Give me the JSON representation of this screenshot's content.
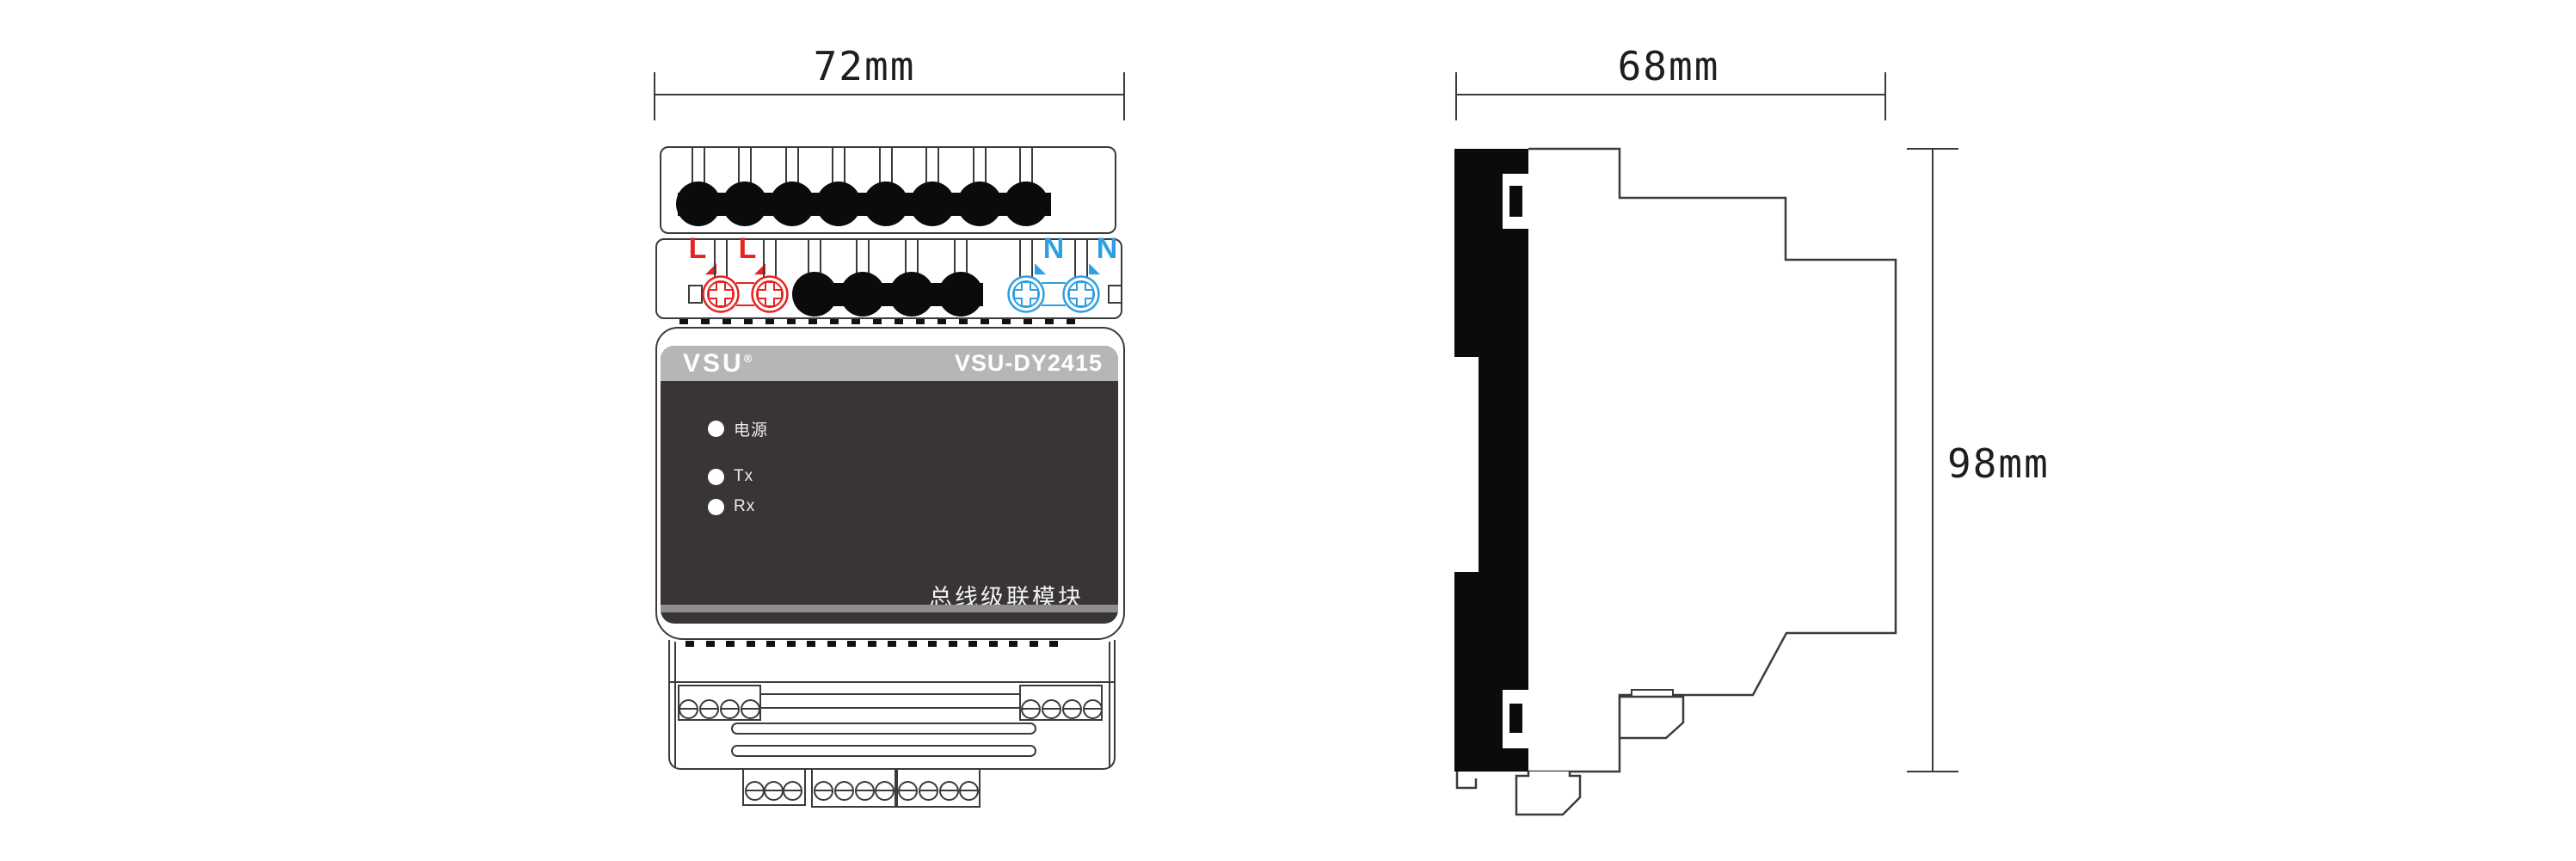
{
  "drawing": {
    "front_view": {
      "dimension_width": "72mm",
      "brand": "VSU",
      "registered_mark": "®",
      "model": "VSU-DY2415",
      "indicators": [
        {
          "label": "电源"
        },
        {
          "label": "Tx"
        },
        {
          "label": "Rx"
        }
      ],
      "caption": "总线级联模块",
      "terminal_labels": {
        "live": "L",
        "neutral": "N"
      }
    },
    "side_view": {
      "dimension_depth": "68mm",
      "dimension_height": "98mm"
    },
    "colors": {
      "live_red": "#e62320",
      "neutral_blue": "#2e9fe0",
      "panel_dark": "#393435",
      "header_gray": "#b4b6b8",
      "line": "#3b3b3b"
    },
    "icons": {
      "down_right_arrow": "◢",
      "down_left_arrow": "◣"
    }
  }
}
